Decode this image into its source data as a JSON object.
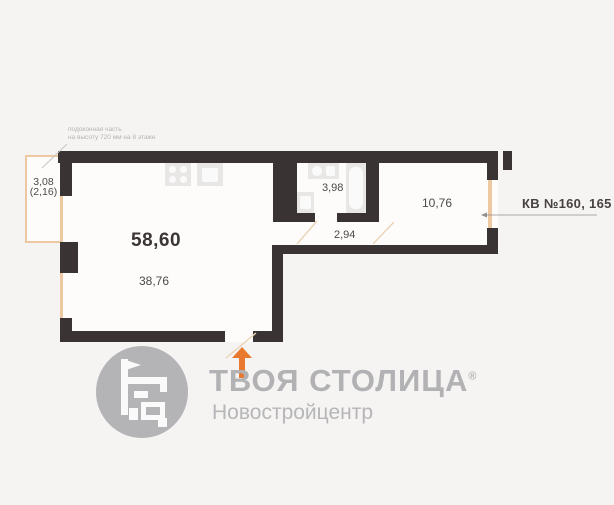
{
  "plan": {
    "annotation": {
      "line1": "подоконная часть",
      "line2": "на высоту 720 мм на 8 этаже"
    },
    "balcony": {
      "dim_full": "3,08",
      "dim_reduced": "(2,16)"
    },
    "areas": {
      "total": "58,60",
      "living_room": "38,76",
      "hallway": "2,94",
      "bathroom": "3,98",
      "bedroom": "10,76"
    },
    "apartment_label": "КВ №160, 165"
  },
  "branding": {
    "name": "ТВОЯ СТОЛИЦА",
    "registered": "®",
    "subtitle": "Новостройцентр"
  },
  "colors": {
    "background": "#f5f4f3",
    "wall": "#3a3333",
    "accent_orange": "#e8792e",
    "window_tan": "#eec8a0",
    "logo_gray": "#b4b4b6",
    "label_dark": "#4a4444",
    "annotation_gray": "#b7b3b1"
  }
}
